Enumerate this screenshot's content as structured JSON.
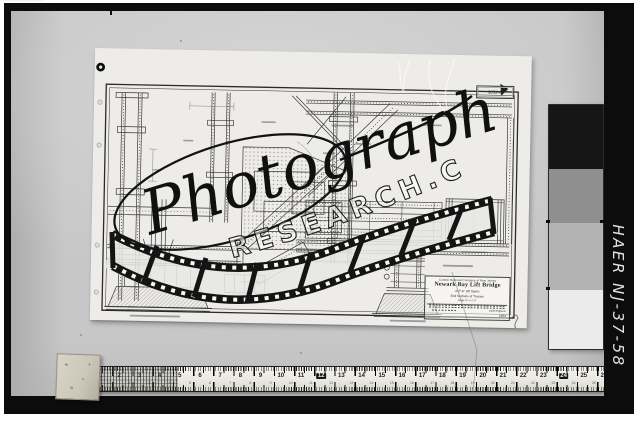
{
  "archive": {
    "label": "HAER NJ-37-58"
  },
  "watermark": {
    "script": "Photograph",
    "arc": "RESEARCH.COM"
  },
  "sticker": {
    "brand": "MICRO-MASTER",
    "film": "105 mm",
    "mag": "5X",
    "year": "1980"
  },
  "ruler": {
    "numbers": [
      1,
      2,
      3,
      4,
      5,
      6,
      7,
      8,
      9,
      10,
      11,
      12,
      13,
      14,
      15,
      16,
      17,
      18,
      19,
      20,
      21,
      22,
      23,
      24,
      25,
      26
    ],
    "boxed": [
      12,
      24
    ]
  },
  "grayscale": {
    "steps": [
      {
        "c": "#161616",
        "h": 64
      },
      {
        "c": "#8f8f8f",
        "h": 54
      },
      {
        "c": "#b3b3b3",
        "h": 67
      },
      {
        "c": "#ebebeb",
        "h": 59
      }
    ]
  },
  "drawing": {
    "number": "3052-D",
    "title_block": {
      "company": "Central Railroad Company of New Jersey",
      "title": "Newark Bay Lift Bridge",
      "line3": "217'-6\" Lift Spans",
      "line4": "End Sections of Trusses",
      "scale": "Scale ¾\" = 1'-0\"",
      "approved": "Chief Engineer",
      "date": "1924"
    }
  },
  "colors": {
    "photo_bg": "#c7c7c7",
    "frame": "#0c0c0c",
    "sheet": "#edece8"
  }
}
